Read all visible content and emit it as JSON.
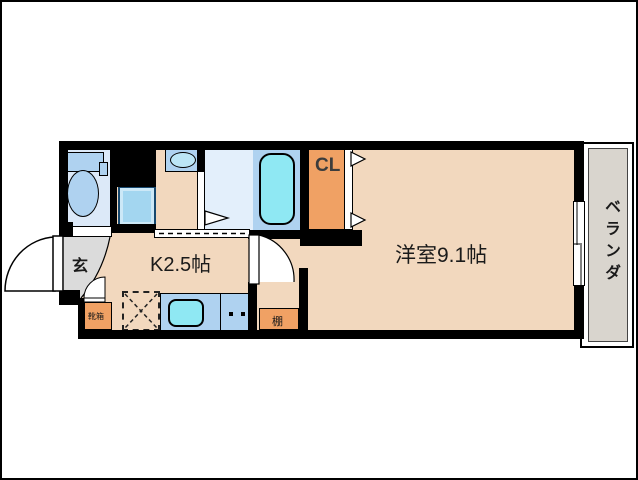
{
  "plan": {
    "type": "apartment-floor-plan-1K",
    "labels": {
      "kitchen": "K2.5帖",
      "western_room": "洋室9.1帖",
      "closet": "CL",
      "veranda": "ベランダ",
      "entrance": "玄",
      "shelf": "棚",
      "shoe_box": "靴箱"
    },
    "colors": {
      "wall": "#000000",
      "floor_beige": "#F2D8BE",
      "accent_orange": "#F0A164",
      "fixture_blue": "#AFD2F0",
      "water_cyan": "#8FE8F3",
      "bath_floor": "#E3EFFB",
      "toilet_floor": "#DCE9F8",
      "entrance_gray": "#DBDBDB",
      "veranda_gray": "#D9D5CE"
    }
  }
}
